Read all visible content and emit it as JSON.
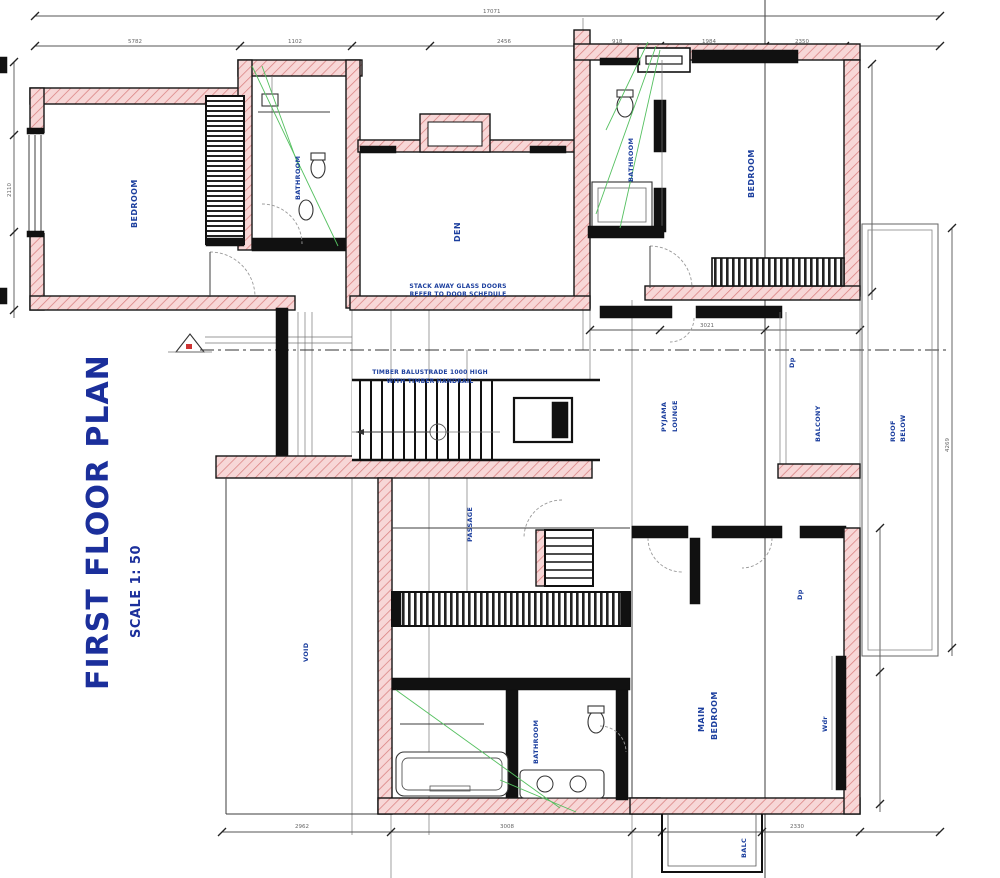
{
  "title": {
    "main": "FIRST FLOOR PLAN",
    "scale": "SCALE 1: 50"
  },
  "colors": {
    "label_blue": "#1c3f9e",
    "title_blue": "#1b2f9b",
    "wall_hatch_pink": "#f7d7d7",
    "hatch_line_red": "#d98080",
    "annotation_green": "#55c060",
    "line_dark": "#151515",
    "dim_gray": "#555555"
  },
  "rooms": {
    "bedroom_left": {
      "label": "BEDROOM"
    },
    "bathroom_left": {
      "label": "BATHROOM"
    },
    "den": {
      "label": "DEN"
    },
    "bathroom_top": {
      "label": "BATHROOM"
    },
    "bedroom_right": {
      "label": "BEDROOM"
    },
    "pyjama": {
      "line1": "PYJAMA",
      "line2": "LOUNGE"
    },
    "balcony": {
      "label": "BALCONY"
    },
    "roof": {
      "line1": "ROOF",
      "line2": "BELOW"
    },
    "void": {
      "label": "VOID"
    },
    "passage": {
      "label": "PASSAGE"
    },
    "bathroom_main": {
      "label": "BATHROOM"
    },
    "main_bedroom": {
      "line1": "MAIN",
      "line2": "BEDROOM"
    },
    "wardrobe": {
      "label": "Wdr"
    },
    "downpipe1": {
      "label": "Dp"
    },
    "downpipe2": {
      "label": "Dp"
    },
    "balcony_lower": {
      "label": "BALC"
    }
  },
  "notes": {
    "stair_line1": "TIMBER BALUSTRADE 1000 HIGH",
    "stair_line2": "WITH TIMBER HANDRAIL",
    "den_line1": "STACK AWAY GLASS DOORS",
    "den_line2": "REFER TO DOOR SCHEDULE"
  },
  "dimensions": {
    "top_overall": "17071",
    "top_seg1": "5782",
    "top_seg2": "1102",
    "top_seg3": "2456",
    "top_seg4": "918",
    "top_seg5": "1984",
    "top_seg6": "2350",
    "mid_right": "3021",
    "bottom_seg1": "2962",
    "bottom_seg2": "3008",
    "bottom_seg3": "2330",
    "left_side": "2110",
    "right_side": "4269"
  }
}
